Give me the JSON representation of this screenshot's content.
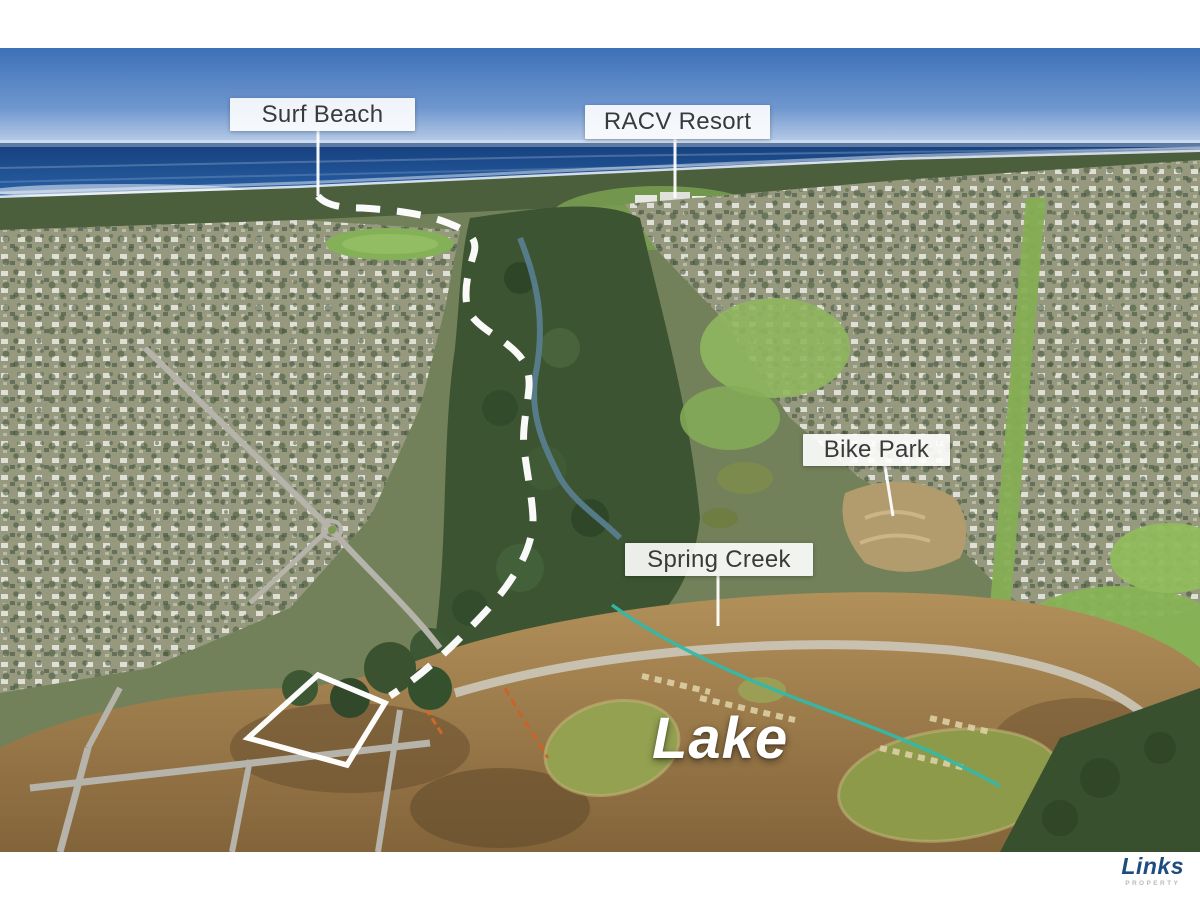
{
  "labels": [
    {
      "name": "surf-beach",
      "text": "Surf Beach"
    },
    {
      "name": "racv-resort",
      "text": "RACV Resort"
    },
    {
      "name": "bike-park",
      "text": "Bike Park"
    },
    {
      "name": "spring-creek",
      "text": "Spring Creek"
    }
  ],
  "map_text": {
    "lake": "Lake"
  },
  "logo": {
    "brand": "Links",
    "tagline": "PROPERTY"
  },
  "colors": {
    "label_background": "#ffffff",
    "label_text": "#3a3a3a",
    "annotation_white": "#ffffff",
    "logo_navy": "#1d4d7f",
    "logo_gray": "#b6bac0",
    "sky_blue": "#3d70b8",
    "ocean_blue": "#1a4a8c",
    "pipe_teal": "#35b8a6"
  }
}
